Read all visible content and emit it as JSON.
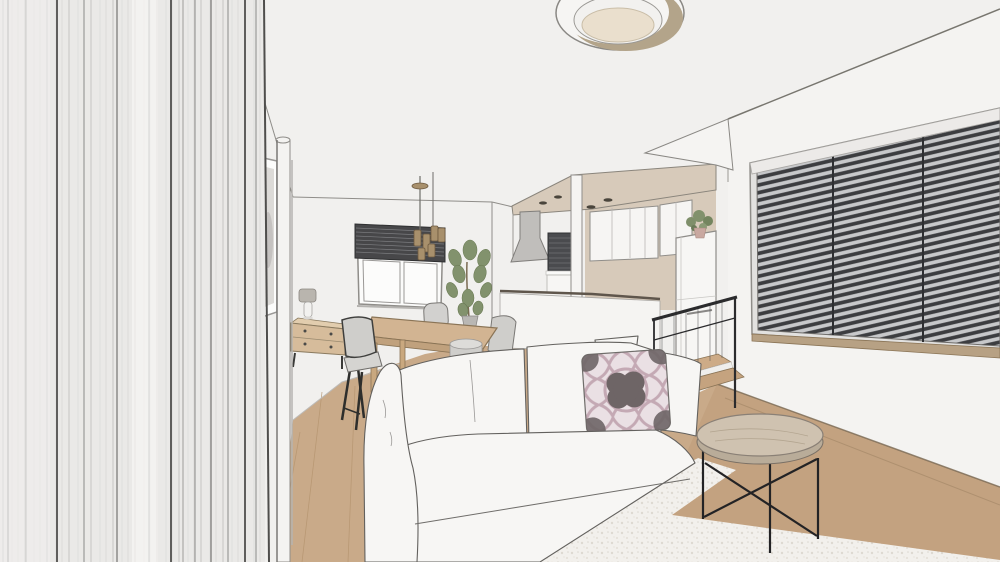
{
  "scene": {
    "type": "interior-rendering",
    "room": "living-dining-room-with-open-kitchen",
    "objects": [
      "left-drapery-panel",
      "framed-artwork",
      "wall-pillar",
      "ceiling-ring-light",
      "pendant-light",
      "dining-window-blind",
      "dining-table",
      "dining-chair",
      "stool",
      "sideboard",
      "table-lamp",
      "fiddle-leaf-plant",
      "kitchen-soffit",
      "range-hood",
      "kitchen-upper-cabinets",
      "kitchen-counter",
      "tall-cabinet",
      "potted-plant",
      "stair-railing",
      "stair-treads",
      "sofa",
      "accent-pillow",
      "white-pillows",
      "coffee-table",
      "area-rug",
      "wood-floor",
      "picture-window-blinds"
    ]
  },
  "palette": {
    "wall": "#f1f0ee",
    "wall_right": "#f4f3f1",
    "left_panel": "#eae9e7",
    "wood_floor": "#c9aa89",
    "wood_floor_dark": "#c3a280",
    "area_rug": "#f2f0ec",
    "kitchen_accent": "#d7caba",
    "blinds_dark": "#3c3d40",
    "blinds_gap": "#c7c8ca",
    "sofa_white": "#f7f6f4",
    "pillow_base": "#eae0e4",
    "pillow_mauve": "#c4a9b4",
    "pillow_motif": "#6e6566",
    "pendant_brass": "#a8906c",
    "table_wood": "#d2b492",
    "coffee_table_top": "#cfc2b0",
    "chair_gray": "#d1d0cd",
    "plant_green": "#81916c",
    "stair_metal": "#2b2b2d",
    "hood_gray": "#c0bebb",
    "ceiling_light_inner": "#eadfcd",
    "ceiling_light_ring": "#b3a48a"
  }
}
